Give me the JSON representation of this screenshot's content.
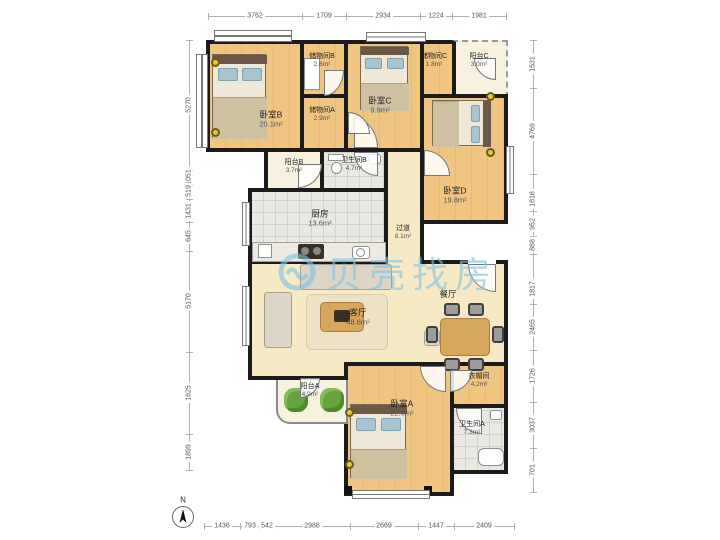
{
  "watermark": {
    "text": "贝壳找房"
  },
  "compass": {
    "label": "N"
  },
  "rooms": {
    "bedroomB": {
      "label": "卧室B",
      "area": "20.1m²"
    },
    "storageB": {
      "label": "储物间B",
      "area": "2.6m²"
    },
    "bedroomC": {
      "label": "卧室C",
      "area": "9.9m²"
    },
    "storageC": {
      "label": "储物间C",
      "area": "1.8m²"
    },
    "balconyC": {
      "label": "阳台C",
      "area": "3.0m²"
    },
    "storageA": {
      "label": "储物间A",
      "area": "2.9m²"
    },
    "bedroomD": {
      "label": "卧室D",
      "area": "19.8m²"
    },
    "balconyB": {
      "label": "阳台B",
      "area": "3.7m²"
    },
    "bathB": {
      "label": "卫生间B",
      "area": "4.7m²"
    },
    "hallway": {
      "label": "过道",
      "area": "8.1m²"
    },
    "kitchen": {
      "label": "厨房",
      "area": "13.6m²"
    },
    "living": {
      "label": "客厅",
      "area": "48.6m²"
    },
    "dining": {
      "label": "餐厅",
      "area": ""
    },
    "balconyA": {
      "label": "阳台A",
      "area": "4.9m²"
    },
    "bedroomA": {
      "label": "卧室A",
      "area": "22.0m²"
    },
    "cloakroom": {
      "label": "衣帽间",
      "area": "4.2m²"
    },
    "bathA": {
      "label": "卫生间A",
      "area": "7.3m²"
    }
  },
  "dimensions": {
    "top": [
      "3762",
      "1709",
      "2934",
      "1224",
      "1981"
    ],
    "bottom": [
      "1436",
      "793",
      "542",
      "2988",
      "2669",
      "1447",
      "2409"
    ],
    "left": [
      "5270",
      "1051",
      "519",
      "1431",
      "645",
      "5170",
      "1625",
      "1899"
    ],
    "right": [
      "1531",
      "4769",
      "1618",
      "952",
      "888",
      "1817",
      "2465",
      "1726",
      "3037",
      "701"
    ]
  },
  "colors": {
    "wall": "#1b1b1b",
    "wood_floor": "#efc07d",
    "tile_floor": "#e8e8e2",
    "living_floor": "#f7e9c3",
    "balcony_floor": "#f7f2df",
    "watermark_blue": "#80c1e6"
  }
}
